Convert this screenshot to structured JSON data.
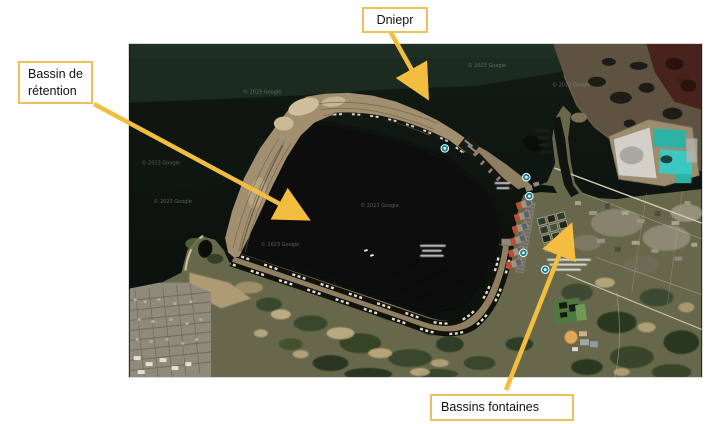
{
  "slide": {
    "background": "#ffffff"
  },
  "map": {
    "kind": "satellite-image",
    "watermark_text": "© 2023 Google"
  },
  "callouts": {
    "dniepr": {
      "label": "Dniepr"
    },
    "bassin_retention": {
      "label": "Bassin de rétention"
    },
    "bassins_fontaines": {
      "label": "Bassins fontaines"
    }
  },
  "colors": {
    "callout_border": "#ECC05C",
    "arrow": "#F3BE3F"
  }
}
